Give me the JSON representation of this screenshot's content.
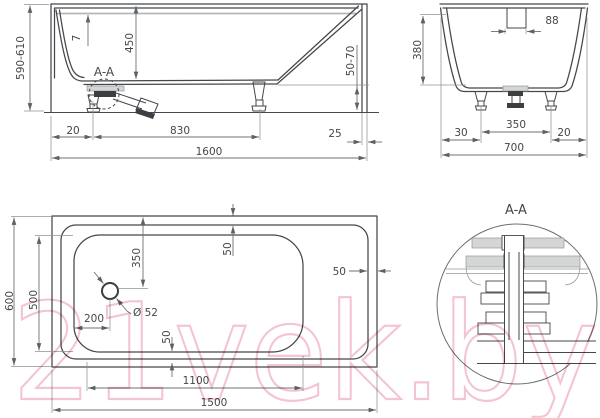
{
  "watermark": "21vek.by",
  "colors": {
    "line": "#44474b",
    "dimension": "#6d7175",
    "gray_fill": "#d4d6d3",
    "watermark_pink": "#f2bfcd"
  },
  "views": {
    "side": {
      "name": "side elevation",
      "labels": {
        "height_range": "590-610",
        "rim_thickness": "7",
        "inner_depth": "450",
        "section_mark": "A-A",
        "left_offset": "20",
        "feet_spacing": "830",
        "foot_adjust_range": "50-70",
        "right_offset": "25",
        "total_length": "1600"
      }
    },
    "end": {
      "name": "end elevation",
      "labels": {
        "overflow_width": "88",
        "inner_depth": "380",
        "left_offset": "30",
        "feet_spacing": "350",
        "right_offset": "20",
        "total_width": "700"
      }
    },
    "plan": {
      "name": "top view",
      "labels": {
        "total_width": "600",
        "bottom_width": "500",
        "drain_from_edge": "350",
        "rim_top": "50",
        "drain_diameter": "Ø 52",
        "drain_from_left": "200",
        "rim_right": "50",
        "rim_bottom": "50",
        "bottom_length": "1100",
        "total_length": "1500"
      }
    },
    "detail": {
      "name": "drain section detail",
      "title": "A-A"
    }
  }
}
